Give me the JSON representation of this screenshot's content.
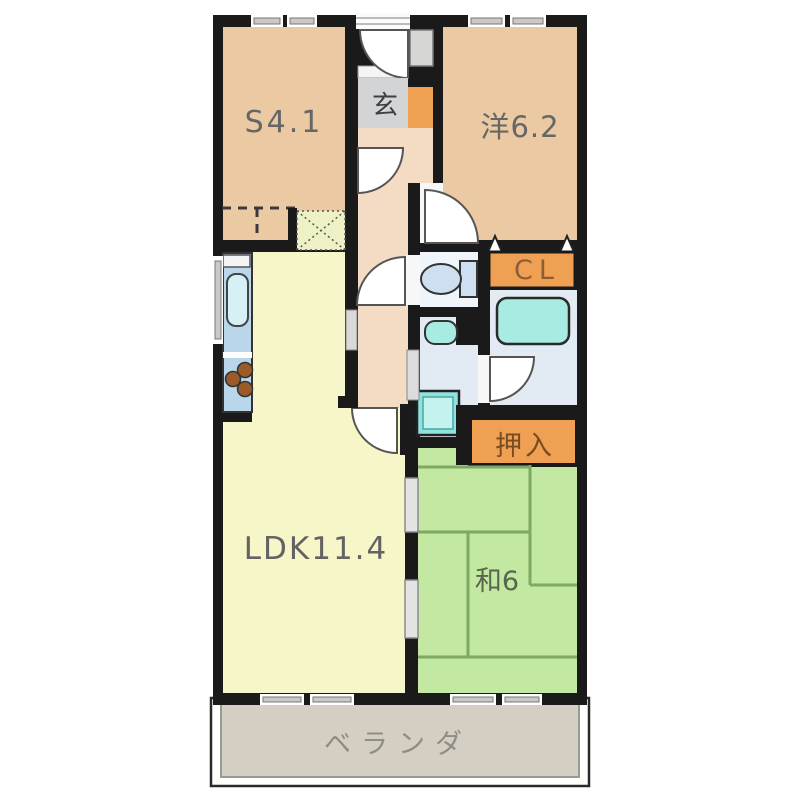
{
  "floor_plan": {
    "rooms": {
      "service_room": "S4.1",
      "entrance": "玄",
      "western_room": "洋6.2",
      "closet": "CL",
      "futon_closet": "押入",
      "living_dining_kitchen": "LDK11.4",
      "japanese_room": "和6",
      "veranda": "ベランダ"
    },
    "colors": {
      "wall": "#1a1a1a",
      "room_tan": "#ebc9a3",
      "hallway_tan": "#f4dcc4",
      "entrance_gray": "#d2d4d6",
      "closet_orange": "#f0a052",
      "ldk_yellow": "#f6f6c9",
      "tatami_green": "#c2e8a2",
      "tatami_line": "#7fa863",
      "wet_area_blue": "#e2ebf3",
      "toilet_room_blue": "#eff5fb",
      "fixture_teal": "#a8ebe3",
      "fixture_blue": "#cfdff2",
      "counter_blue": "#b9d6ea",
      "veranda_gray": "#d5cec2",
      "refrigerator_pad": "#eef0c6"
    }
  }
}
